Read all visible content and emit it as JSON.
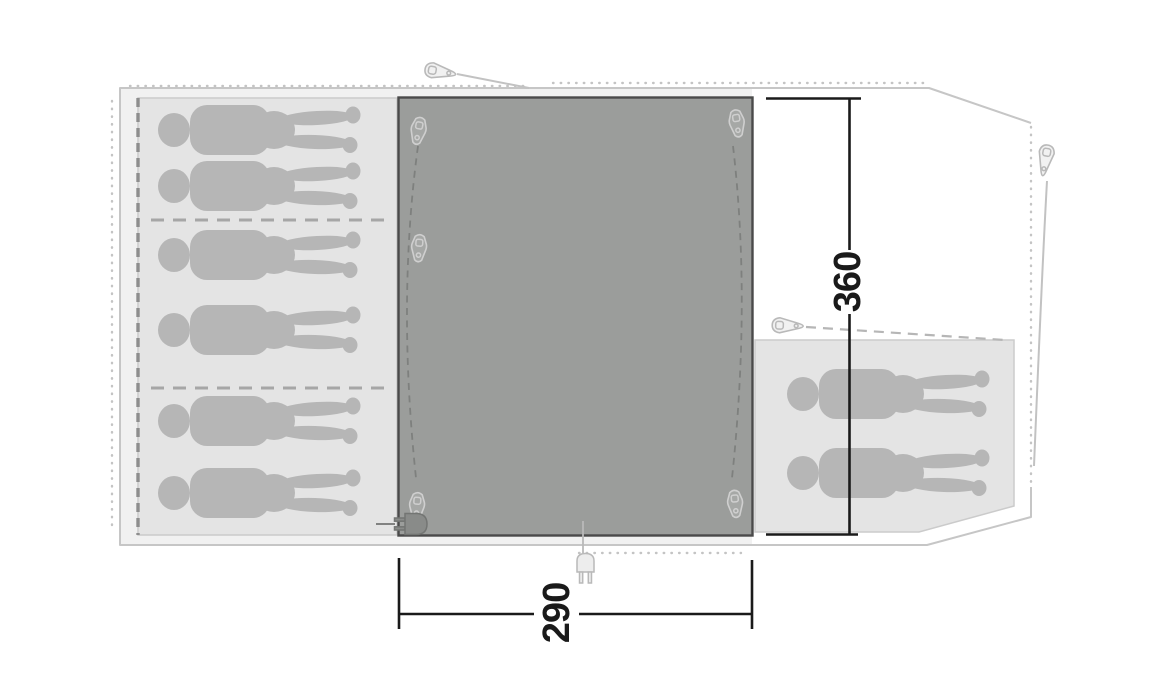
{
  "diagram": {
    "type": "tent floor plan (top view)",
    "dimension_labels": {
      "vertical": "360",
      "horizontal": "290"
    },
    "sleeping_cabins": [
      {
        "id": "left-cabin",
        "capacity": 6
      },
      {
        "id": "right-cabin",
        "capacity": 2
      }
    ],
    "living_area": {
      "zipper_pulls": 5,
      "power_inlets": 2
    },
    "guy_line_toggles": 3,
    "icons": {
      "zipper_pull": "zipper-pull-icon",
      "guy_line_toggle": "guy-line-toggle-icon",
      "power_plug": "power-plug-icon",
      "person": "person-silhouette"
    }
  },
  "colors": {
    "background": "#ffffff",
    "floor": "#f1f1f1",
    "outline": "#c6c6c6",
    "seam": "#c4c4c4",
    "cabin": "#e4e4e4",
    "cabin_border": "#cbcbcb",
    "dash_dark": "#8e8e8e",
    "dash_mid": "#a6a6a6",
    "dash_light": "#b6b6b6",
    "person": "#b6b6b6",
    "panel": "#9b9d9b",
    "panel_border": "#4a4a4a",
    "track": "#7e807e",
    "pull_fill": "#a6a8a6",
    "pull_stroke": "#cfcfcf",
    "toggle_fill": "#f1f1f1",
    "toggle_stroke": "#b9b9b9",
    "guy": "#c2c2c2",
    "plug_fill": "#ededed",
    "plug_stroke": "#b9b9b9",
    "plug_dark_fill": "#898b89",
    "plug_dark_stroke": "#737573",
    "dim": "#1a1a1a"
  }
}
